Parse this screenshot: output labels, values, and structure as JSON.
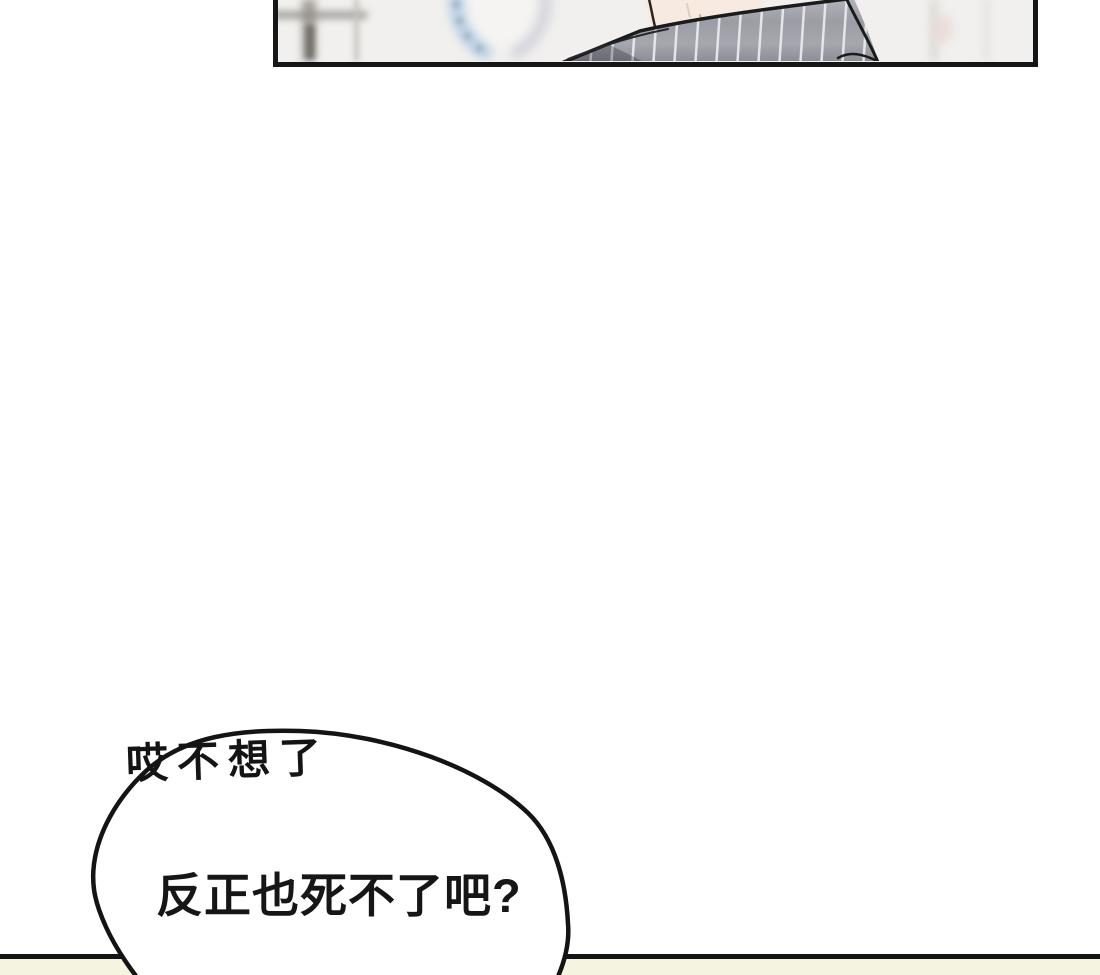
{
  "comic": {
    "speech": {
      "annotation": "哎不想了",
      "line": "反正也死不了吧?"
    },
    "colors": {
      "ink": "#141414",
      "panel_border": "#161616",
      "panel_background": "#f1f0ee",
      "fabric_gray": "#9b9ca4",
      "fabric_stripe": "#eceef0",
      "skin": "#f7ebe1",
      "clock_ring_blue": "#b8cfe4",
      "clock_ring_gray": "#d3d2db",
      "bottom_strip": "#f5f4e0",
      "bubble_fill": "#ffffff"
    }
  }
}
